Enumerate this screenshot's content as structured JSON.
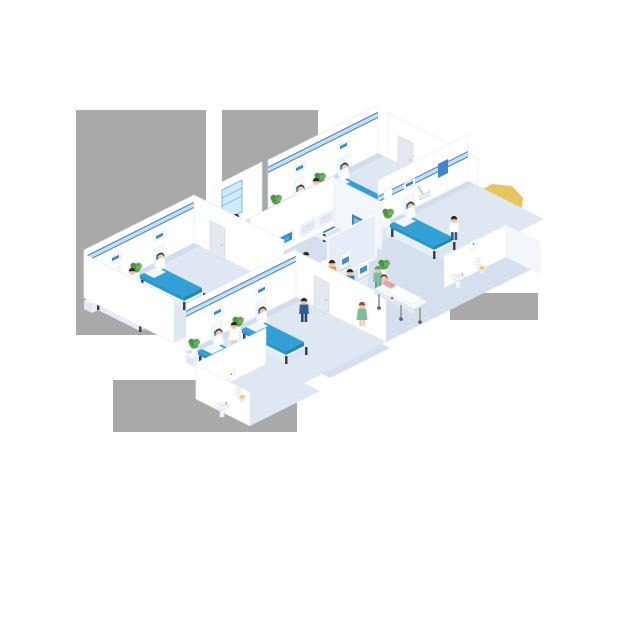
{
  "scene": {
    "type": "isometric-hospital-floor-illustration",
    "background": "white with gray transparency-artifact patches",
    "reception": {
      "sign_text": "P+SM"
    },
    "rooms": [
      {
        "name": "ward-top",
        "beds": 2,
        "patients_in_bed": 2,
        "staff": 1,
        "plants": 2
      },
      {
        "name": "ward-right",
        "beds": 1,
        "patients_in_bed": 1,
        "staff": 1,
        "plants": 1
      },
      {
        "name": "ward-left",
        "beds": 2,
        "patients_in_bed": 2,
        "staff": 1,
        "plants": 2
      },
      {
        "name": "ward-bottom",
        "beds": 2,
        "patients_in_bed": 2,
        "staff": 1,
        "plants": 2
      },
      {
        "name": "xray-viewing-room",
        "wall_monitors": 4
      },
      {
        "name": "bathroom-east",
        "fixtures": [
          "pedestal-sink",
          "toilet"
        ]
      },
      {
        "name": "bathroom-southwest",
        "fixtures": [
          "pedestal-sink",
          "toilet"
        ]
      }
    ],
    "lobby": {
      "reception_desk": true,
      "receptionist": 1,
      "checkin_kiosks": 2,
      "kiosk_users": 2,
      "walking_figures": [
        "businessman-navy",
        "nurse-green-dress",
        "surgeon-green-scrubs"
      ],
      "gurney_with_patient": 1
    }
  },
  "icons": [
    "hospital-bed-icon",
    "plant-icon",
    "pedestal-sink-icon",
    "toilet-icon",
    "wall-monitor-icon",
    "door-icon",
    "checkin-kiosk-icon",
    "gurney-icon",
    "wall-plaque-icon",
    "overbed-light-icon"
  ],
  "colors": {
    "wall": "#ffffff",
    "wall_side": "#f3f6fa",
    "floor_room": "#dfe7f3",
    "floor_corridor": "#d5dfee",
    "wall_stripe": "#c8ddf1",
    "wall_stripe_line": "#4d8cc9",
    "mattress": "#31a0d6",
    "mattress_dark": "#2387b8",
    "accent_blue": "#3f86cc",
    "desk_navy": "#1d4a8c",
    "desk_panel": "#cfe0f0",
    "skin": "#f2c59e",
    "hair": "#2e2a28",
    "scrub_green": "#7bbf9c",
    "suit_navy": "#2d5e92",
    "shirt_orange": "#ef9a3d",
    "shirt_blue": "#3e78b5",
    "patient_pink": "#ef9f9f",
    "plant_green": "#5aa34e",
    "yellow_blob": "#e7c65e",
    "gray_patch": "#a9a9a9",
    "cross_red": "#d9534f"
  }
}
